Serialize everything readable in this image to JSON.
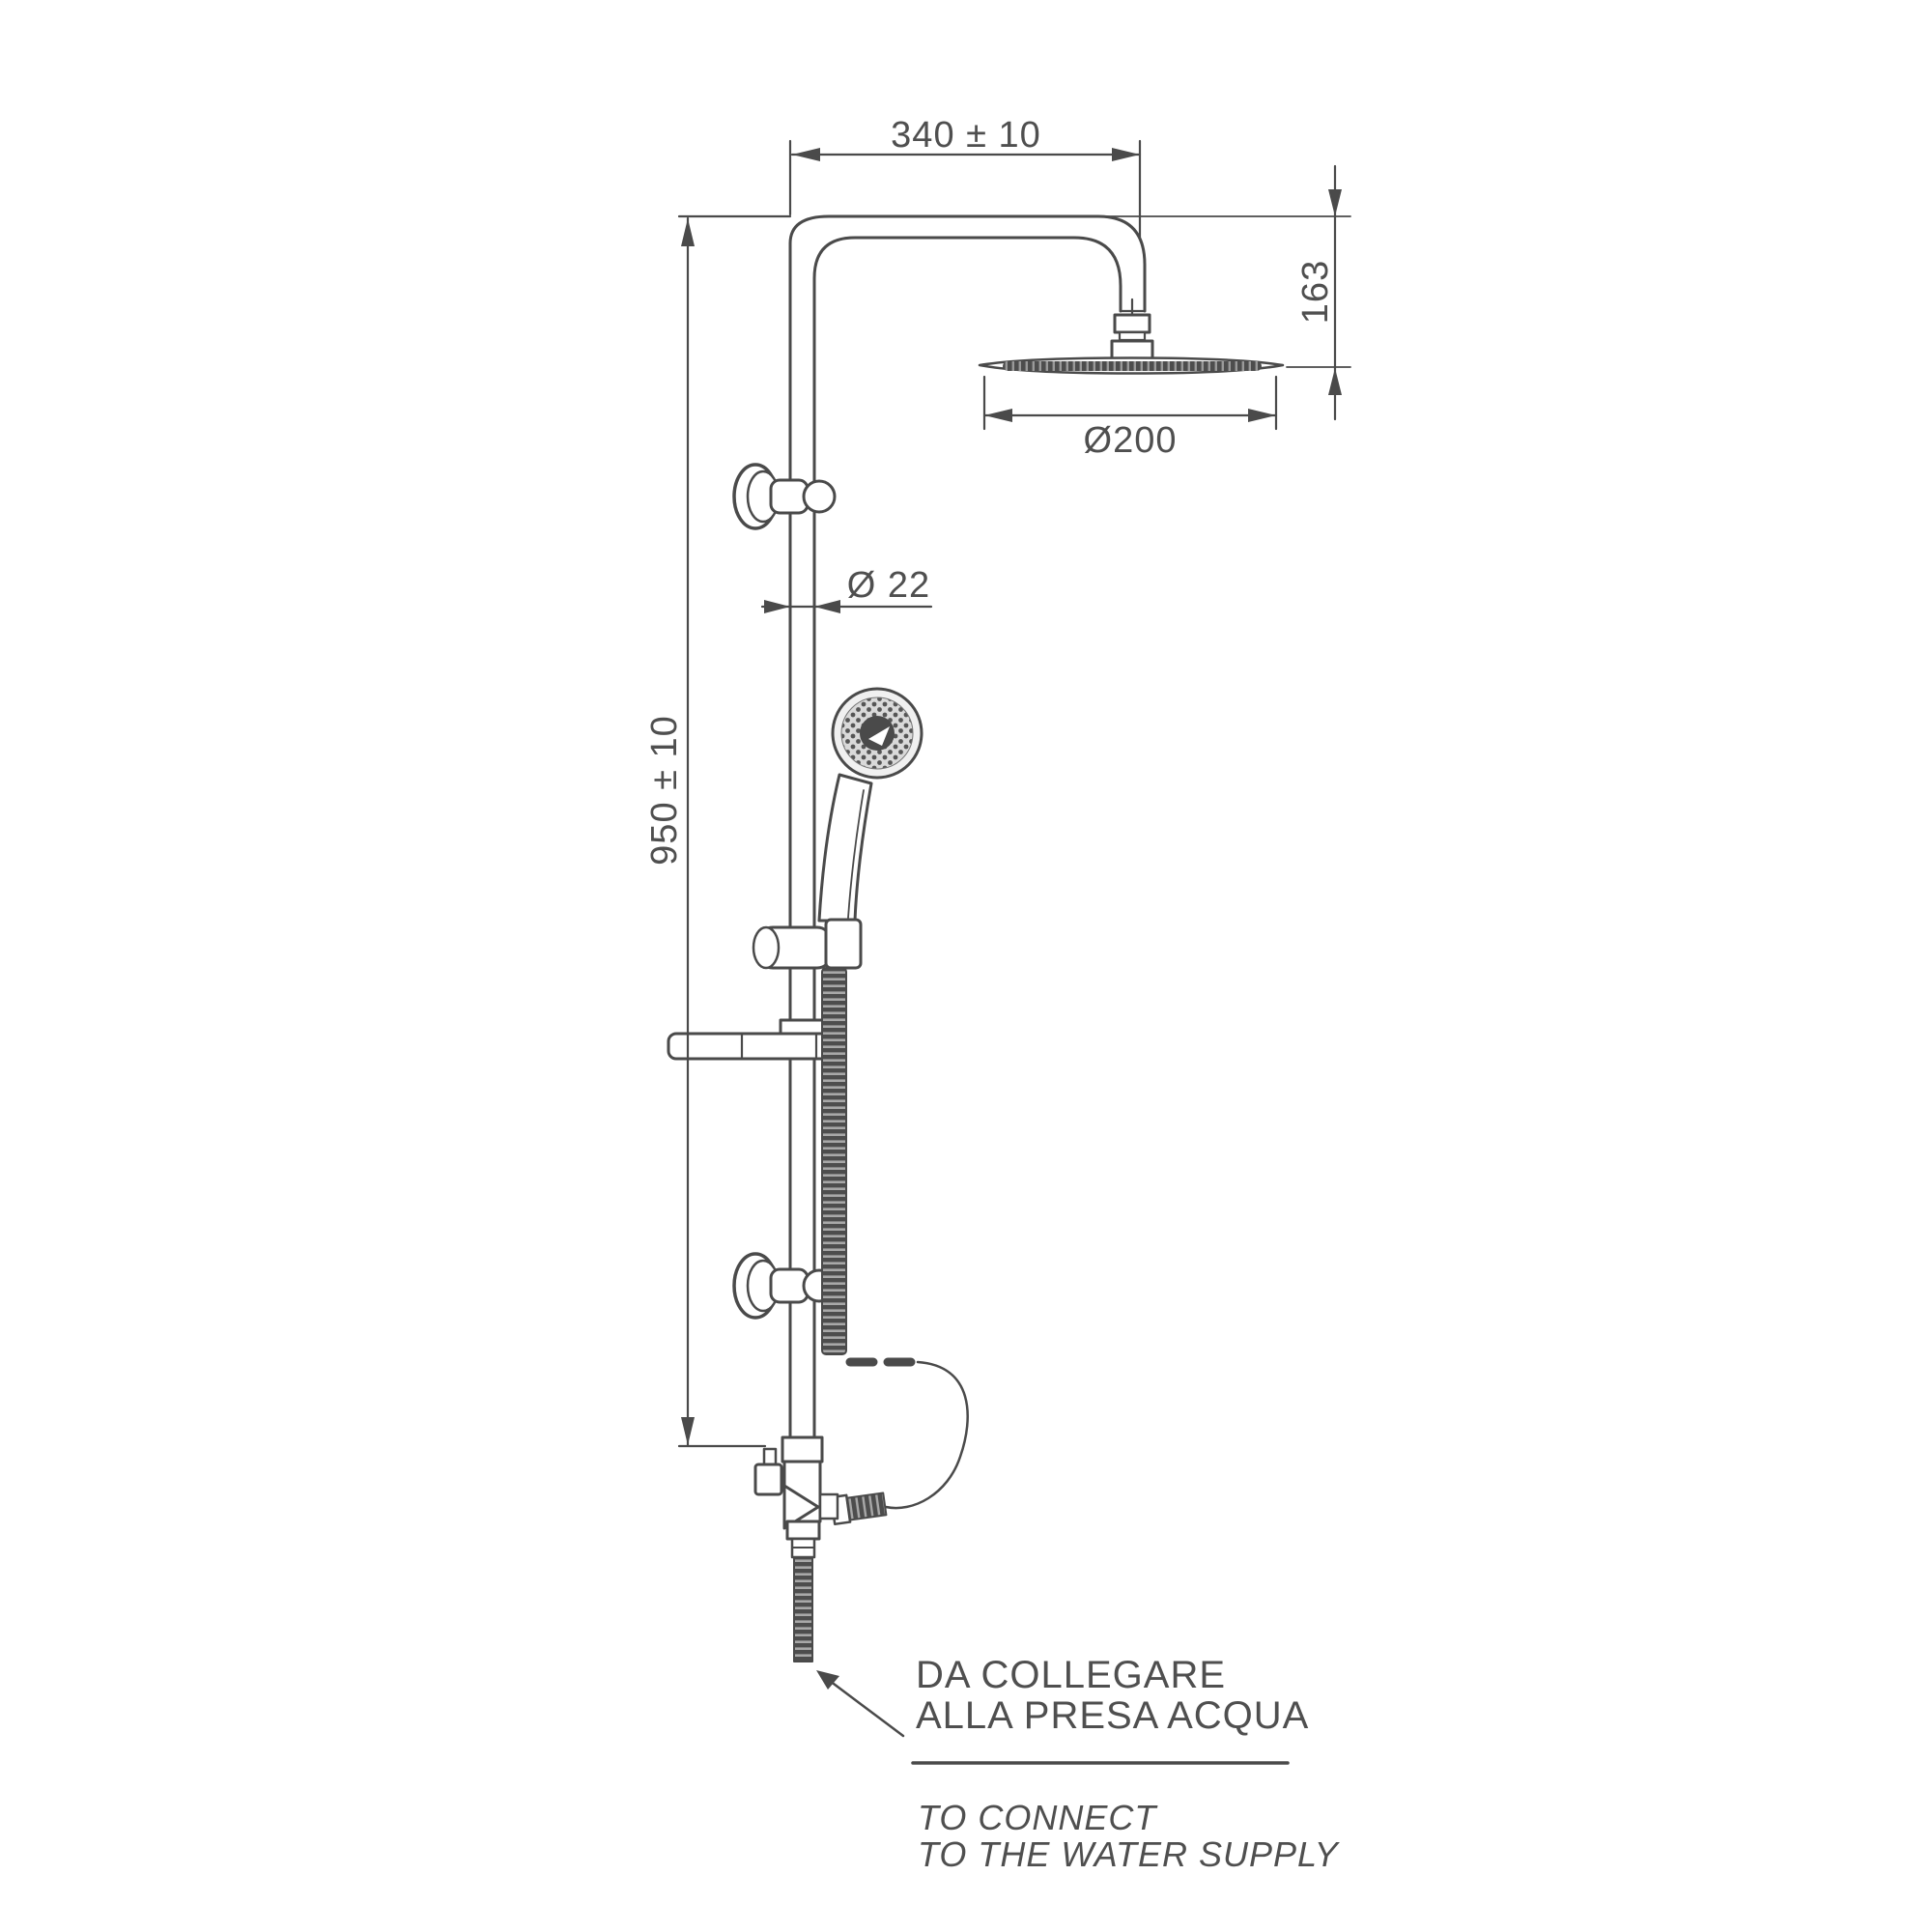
{
  "diagram": {
    "dimensions": {
      "arm_reach": "340 ± 10",
      "head_drop": "163",
      "head_diameter": "Ø200",
      "pipe_diameter": "Ø 22",
      "column_height": "950 ± 10"
    },
    "notes": {
      "italian": [
        "DA COLLEGARE",
        "ALLA PRESA ACQUA"
      ],
      "english": [
        "TO CONNECT",
        "TO THE WATER SUPPLY"
      ]
    },
    "colors": {
      "line": "#4a4a4a",
      "text": "#4f4f4f",
      "background": "#ffffff"
    }
  }
}
